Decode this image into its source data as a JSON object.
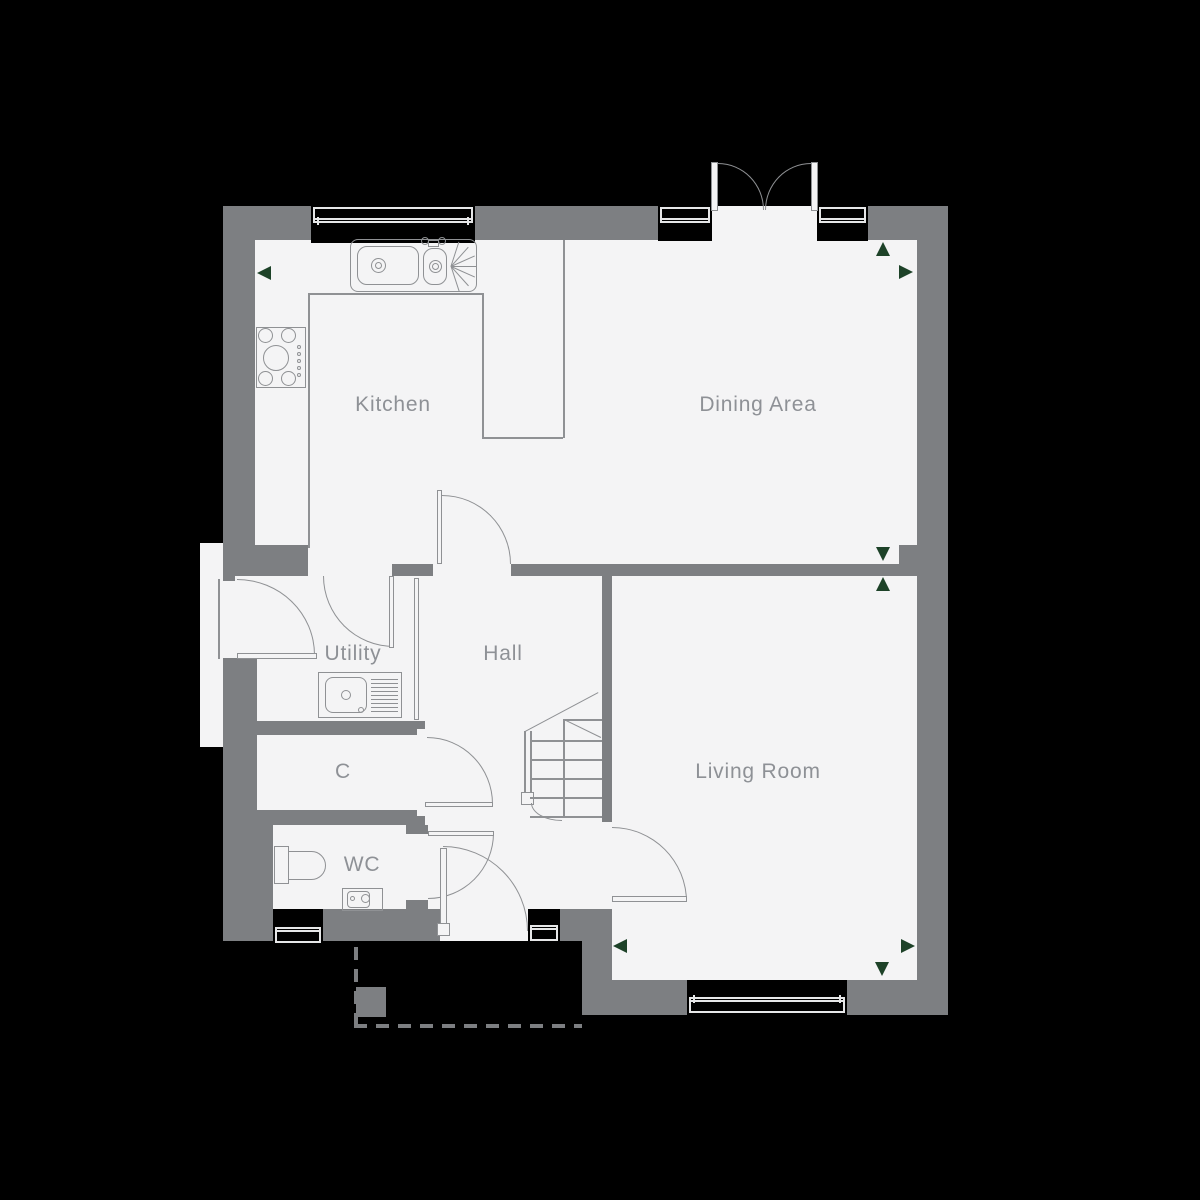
{
  "canvas": {
    "background": "#000000"
  },
  "palette": {
    "wall": "#7d7f82",
    "floor": "#f4f4f5",
    "line": "#8f9194",
    "label": "#8e9196",
    "marker_green": "#1d4228",
    "window_frame": "#e6e7e8"
  },
  "rooms": [
    {
      "id": "kitchen",
      "label": "Kitchen"
    },
    {
      "id": "dining",
      "label": "Dining Area"
    },
    {
      "id": "utility",
      "label": "Utility"
    },
    {
      "id": "hall",
      "label": "Hall"
    },
    {
      "id": "cupboard",
      "label": "C"
    },
    {
      "id": "wc",
      "label": "WC"
    },
    {
      "id": "living",
      "label": "Living Room"
    }
  ],
  "fixtures": [
    "kitchen-sink",
    "hob",
    "worktop",
    "utility-sink",
    "toilet",
    "wash-basin",
    "staircase"
  ],
  "doors": [
    "french-doors",
    "front-door",
    "back-door",
    "kitchen-door",
    "kitchen-utility-door",
    "cupboard-door",
    "wc-door",
    "living-room-door"
  ],
  "windows": [
    "kitchen-window",
    "dining-window-left",
    "dining-window-right",
    "wc-window",
    "hall-window",
    "living-room-window"
  ],
  "markers": [
    {
      "dir": "left",
      "at": "kitchen-west-wall"
    },
    {
      "dir": "up",
      "at": "dining-north-east"
    },
    {
      "dir": "right",
      "at": "dining-east-wall"
    },
    {
      "dir": "down",
      "at": "dining-south-east"
    },
    {
      "dir": "up",
      "at": "living-north-east"
    },
    {
      "dir": "left",
      "at": "living-south-west"
    },
    {
      "dir": "right",
      "at": "living-south-east"
    },
    {
      "dir": "down",
      "at": "living-south-east-2"
    }
  ],
  "porch": {
    "style": "dashed-outline",
    "post": true
  }
}
